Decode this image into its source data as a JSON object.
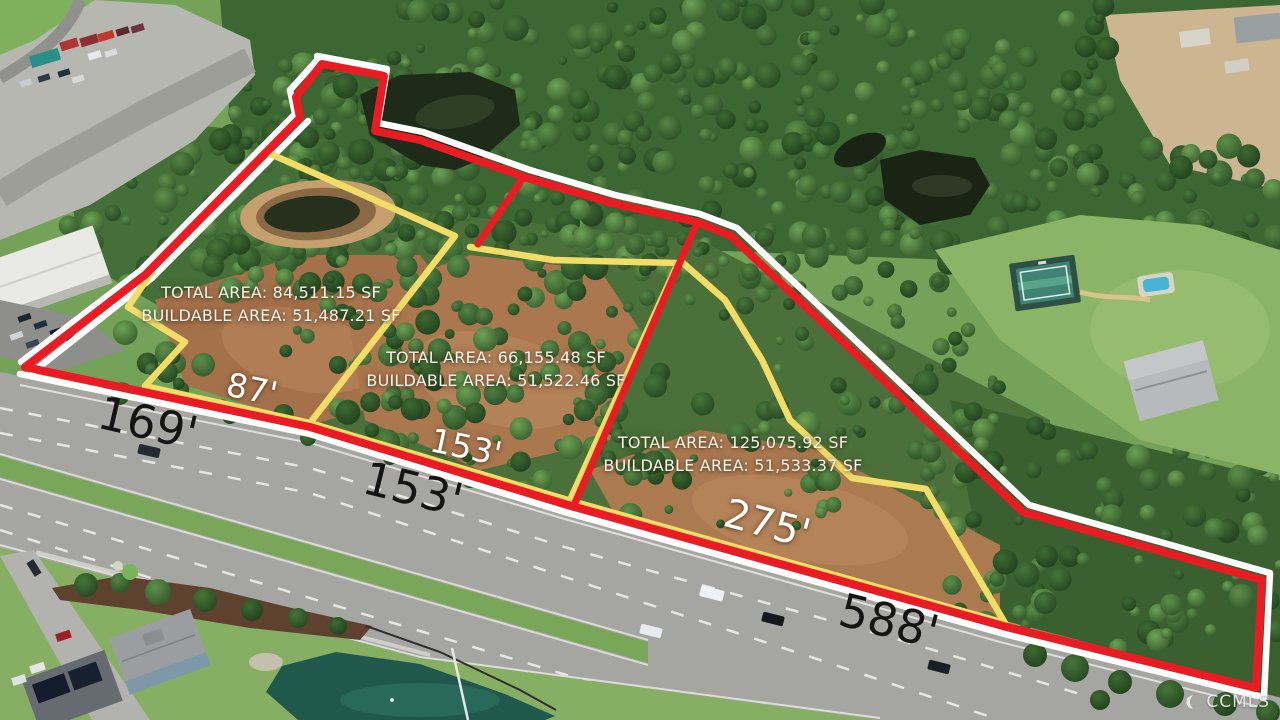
{
  "photo": {
    "description": "aerial-photo-of-land-parcels-with-boundary-overlay"
  },
  "parcels": [
    {
      "name": "parcel-1",
      "total_area": "TOTAL AREA: 84,511.15 SF",
      "buildable_area": "BUILDABLE AREA: 51,487.21 SF"
    },
    {
      "name": "parcel-2",
      "total_area": "TOTAL AREA: 66,155.48 SF",
      "buildable_area": "BUILDABLE AREA: 51,522.46 SF"
    },
    {
      "name": "parcel-3",
      "total_area": "TOTAL AREA: 125,075.92 SF",
      "buildable_area": "BUILDABLE AREA: 51,533.37 SF"
    }
  ],
  "dimensions": [
    {
      "label": "169'",
      "color": "#141414"
    },
    {
      "label": "87'",
      "color": "#ffffff"
    },
    {
      "label": "153'",
      "color": "#ffffff"
    },
    {
      "label": "153'",
      "color": "#141414"
    },
    {
      "label": "275'",
      "color": "#ffffff"
    },
    {
      "label": "588'",
      "color": "#141414"
    }
  ],
  "watermark": {
    "label": "CCMLS",
    "icon": "crescent-logo"
  },
  "colors": {
    "boundary_red": "#ea1b23",
    "divider_yellow": "#f3dd66",
    "casing_white": "#ffffff"
  }
}
